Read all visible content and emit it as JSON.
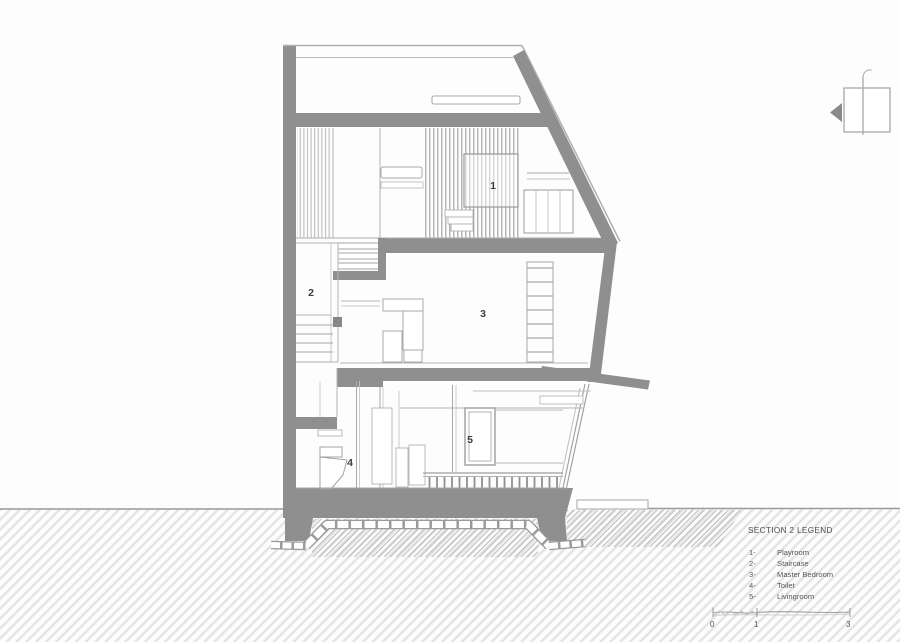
{
  "drawing": {
    "type": "architectural-building-section",
    "rooms": [
      {
        "number": "1"
      },
      {
        "number": "2"
      },
      {
        "number": "3"
      },
      {
        "number": "4"
      },
      {
        "number": "5"
      }
    ]
  },
  "legend": {
    "title": "SECTION 2 LEGEND",
    "items": [
      {
        "num": "1-",
        "label": "Playroom"
      },
      {
        "num": "2-",
        "label": "Staircase"
      },
      {
        "num": "3-",
        "label": "Master Bedroom"
      },
      {
        "num": "4-",
        "label": "Toilet"
      },
      {
        "num": "5-",
        "label": "Livingroom"
      }
    ]
  },
  "scale_bar": {
    "ticks": [
      "0",
      "1",
      "3"
    ]
  },
  "colors": {
    "wall_gray": "#8f8f8f",
    "outline_gray": "#a8a8a8",
    "thin_line": "#b3b3b3",
    "hatch_light": "#e3e3e3",
    "hatch_dense": "#bcbcbc",
    "text": "#4a4a4a",
    "background": "#fdfdfd"
  }
}
